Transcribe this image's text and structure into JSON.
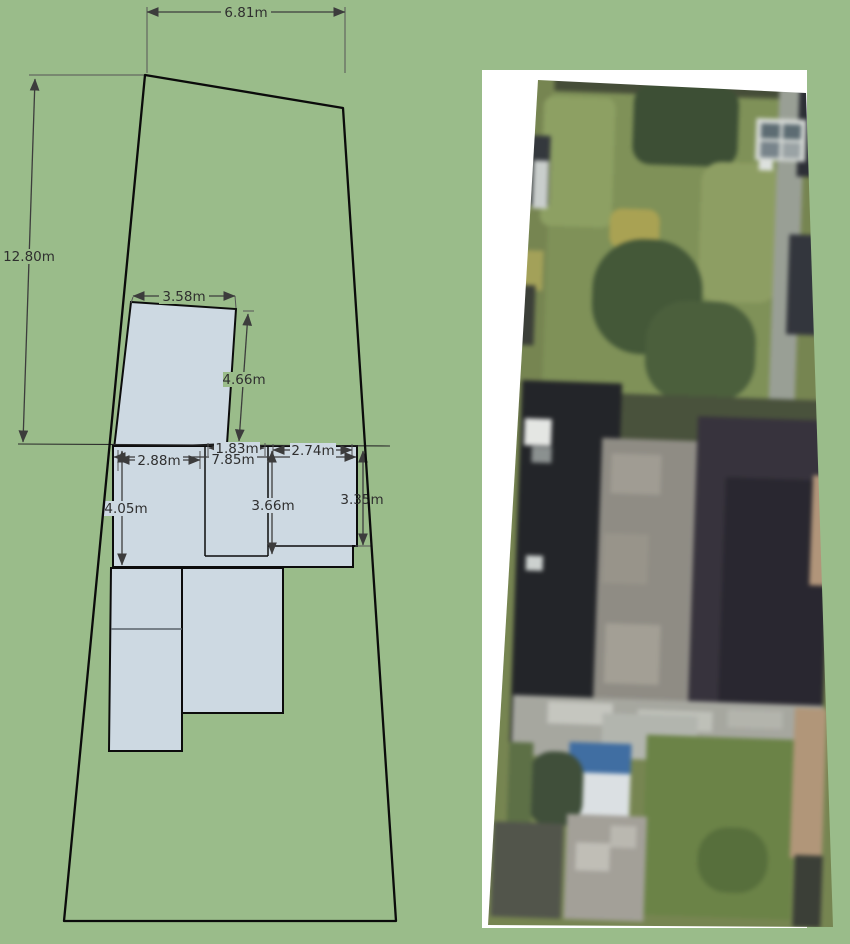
{
  "site_plan": {
    "description": "Dimensioned site plan of plot with outbuilding and house footprint",
    "colors": {
      "background": "#9abc8a",
      "building_fill": "#cdd9e2",
      "outline": "#0c0c0c",
      "dimension_line": "#3c3c3c",
      "dimension_text": "#2f2f2f",
      "divider": "#5a626a"
    },
    "dimensions": {
      "plot_width_top": "6.81m",
      "plot_depth_left": "12.80m",
      "outbuilding_width": "3.58m",
      "outbuilding_depth": "4.66m",
      "room_a_width": "2.88m",
      "house_total_width": "7.85m",
      "room_b_width": "1.83m",
      "room_c_width": "2.74m",
      "room_a_depth": "4.05m",
      "room_b_depth": "3.66m",
      "room_c_depth": "3.35m"
    }
  },
  "aerial": {
    "description": "Aerial photo of same plot: rear garden top, house roofs centre, front garden and driveway bottom",
    "backing_color": "#ffffff",
    "base_color": "#76854f",
    "patches": [
      {
        "name": "fence-top",
        "x": 80,
        "y": 23,
        "w": 262,
        "h": 20,
        "color": "#454d37"
      },
      {
        "name": "lawn-main",
        "x": 78,
        "y": 40,
        "w": 250,
        "h": 350,
        "color": "#7e9155"
      },
      {
        "name": "shrubs-left",
        "x": 70,
        "y": 45,
        "w": 72,
        "h": 130,
        "color": "#8ca060",
        "r": 10
      },
      {
        "name": "tree-shadow",
        "x": 160,
        "y": 30,
        "w": 105,
        "h": 80,
        "color": "#3c4f34",
        "r": 18
      },
      {
        "name": "lawn-bright",
        "x": 230,
        "y": 105,
        "w": 80,
        "h": 140,
        "color": "#8d9e60",
        "r": 20
      },
      {
        "name": "yellow-patch",
        "x": 140,
        "y": 155,
        "w": 50,
        "h": 40,
        "color": "#aaa24f",
        "r": 12
      },
      {
        "name": "big-tree",
        "x": 125,
        "y": 185,
        "w": 110,
        "h": 115,
        "color": "#435837",
        "r": 50
      },
      {
        "name": "dark-tree-2",
        "x": 180,
        "y": 245,
        "w": 110,
        "h": 100,
        "color": "#4a5f3b",
        "r": 40
      },
      {
        "name": "yellow-left-edge",
        "x": 45,
        "y": 200,
        "w": 30,
        "h": 40,
        "color": "#a3a155"
      },
      {
        "name": "path-right",
        "x": 305,
        "y": 25,
        "w": 26,
        "h": 330,
        "color": "#999f95"
      },
      {
        "name": "roofs-topright",
        "x": 325,
        "y": 5,
        "w": 44,
        "h": 112,
        "color": "#2c2f36"
      },
      {
        "name": "greenhouse-frame",
        "x": 283,
        "y": 60,
        "w": 50,
        "h": 42,
        "color": "#d6dad6"
      },
      {
        "name": "greenhouse-pane-1",
        "x": 288,
        "y": 65,
        "w": 19,
        "h": 15,
        "color": "#5c6c73"
      },
      {
        "name": "greenhouse-pane-2",
        "x": 310,
        "y": 65,
        "w": 18,
        "h": 15,
        "color": "#5c6c73"
      },
      {
        "name": "greenhouse-pane-3",
        "x": 288,
        "y": 83,
        "w": 19,
        "h": 16,
        "color": "#77848b"
      },
      {
        "name": "greenhouse-pane-4",
        "x": 310,
        "y": 83,
        "w": 18,
        "h": 16,
        "color": "#9aa3a5"
      },
      {
        "name": "white-dot-right",
        "x": 287,
        "y": 102,
        "w": 14,
        "h": 10,
        "color": "#dde1de"
      },
      {
        "name": "roof-right-mid",
        "x": 320,
        "y": 175,
        "w": 40,
        "h": 100,
        "color": "#33363d"
      },
      {
        "name": "left-dark-edge",
        "x": 58,
        "y": 85,
        "w": 20,
        "h": 70,
        "color": "#34383d"
      },
      {
        "name": "left-white-strip",
        "x": 62,
        "y": 110,
        "w": 15,
        "h": 48,
        "color": "#c9cecc"
      },
      {
        "name": "left-dark-2",
        "x": 48,
        "y": 235,
        "w": 20,
        "h": 60,
        "color": "#3b3f38"
      },
      {
        "name": "hedge-band",
        "x": 60,
        "y": 340,
        "w": 310,
        "h": 50,
        "color": "#49523b"
      },
      {
        "name": "roof-dark-left",
        "x": 58,
        "y": 330,
        "w": 100,
        "h": 375,
        "color": "#232529"
      },
      {
        "name": "roof-light-center",
        "x": 140,
        "y": 385,
        "w": 95,
        "h": 270,
        "color": "#8f8c84"
      },
      {
        "name": "roof-light-mottle-1",
        "x": 150,
        "y": 400,
        "w": 50,
        "h": 40,
        "color": "#a09c92"
      },
      {
        "name": "roof-light-mottle-2",
        "x": 145,
        "y": 480,
        "w": 45,
        "h": 50,
        "color": "#989489"
      },
      {
        "name": "roof-light-mottle-3",
        "x": 150,
        "y": 570,
        "w": 55,
        "h": 60,
        "color": "#a39f94"
      },
      {
        "name": "roof-right",
        "x": 235,
        "y": 360,
        "w": 135,
        "h": 345,
        "color": "#37333d"
      },
      {
        "name": "roof-right-inner",
        "x": 265,
        "y": 420,
        "w": 105,
        "h": 260,
        "color": "#292730"
      },
      {
        "name": "white-block-left",
        "x": 62,
        "y": 368,
        "w": 27,
        "h": 27,
        "color": "#e4e6e3"
      },
      {
        "name": "gray-block-left",
        "x": 70,
        "y": 396,
        "w": 20,
        "h": 16,
        "color": "#8b9190"
      },
      {
        "name": "white-dot-left-2",
        "x": 68,
        "y": 505,
        "w": 17,
        "h": 15,
        "color": "#ccd1cf"
      },
      {
        "name": "right-tan-mid",
        "x": 352,
        "y": 415,
        "w": 24,
        "h": 110,
        "color": "#b29578"
      },
      {
        "name": "patio-band",
        "x": 60,
        "y": 645,
        "w": 310,
        "h": 60,
        "color": "#a6a79f"
      },
      {
        "name": "patio-streak-1",
        "x": 95,
        "y": 650,
        "w": 65,
        "h": 22,
        "color": "#c5c6bf"
      },
      {
        "name": "patio-streak-2",
        "x": 185,
        "y": 655,
        "w": 75,
        "h": 20,
        "color": "#bec0b8"
      },
      {
        "name": "patio-streak-3",
        "x": 275,
        "y": 652,
        "w": 55,
        "h": 18,
        "color": "#b3b4ac"
      },
      {
        "name": "conservatory",
        "x": 150,
        "y": 660,
        "w": 95,
        "h": 45,
        "color": "#b2b5ae"
      },
      {
        "name": "blue-tarp",
        "x": 118,
        "y": 690,
        "w": 62,
        "h": 30,
        "color": "#3e6ea5"
      },
      {
        "name": "white-van",
        "x": 122,
        "y": 720,
        "w": 58,
        "h": 42,
        "color": "#dbe0e3"
      },
      {
        "name": "shrub-bottom-left",
        "x": 78,
        "y": 700,
        "w": 55,
        "h": 75,
        "color": "#3f4f39",
        "r": 24
      },
      {
        "name": "lawn-bottom",
        "x": 195,
        "y": 680,
        "w": 150,
        "h": 180,
        "color": "#6a8344"
      },
      {
        "name": "lawn-dark-patch",
        "x": 250,
        "y": 770,
        "w": 70,
        "h": 65,
        "color": "#566f3a",
        "r": 30
      },
      {
        "name": "path-bottom",
        "x": 118,
        "y": 762,
        "w": 80,
        "h": 105,
        "color": "#a3a098"
      },
      {
        "name": "path-speck-1",
        "x": 128,
        "y": 790,
        "w": 34,
        "h": 28,
        "color": "#c0beb6"
      },
      {
        "name": "path-speck-2",
        "x": 162,
        "y": 772,
        "w": 26,
        "h": 22,
        "color": "#bab8b0"
      },
      {
        "name": "left-bottom-dark",
        "x": 45,
        "y": 772,
        "w": 70,
        "h": 95,
        "color": "#52554b"
      },
      {
        "name": "left-bottom-green",
        "x": 58,
        "y": 692,
        "w": 24,
        "h": 80,
        "color": "#5c7044"
      },
      {
        "name": "right-tan-bottom",
        "x": 342,
        "y": 648,
        "w": 32,
        "h": 150,
        "color": "#b29677"
      },
      {
        "name": "right-dark-bottom",
        "x": 347,
        "y": 795,
        "w": 28,
        "h": 72,
        "color": "#3b3f37"
      }
    ]
  }
}
